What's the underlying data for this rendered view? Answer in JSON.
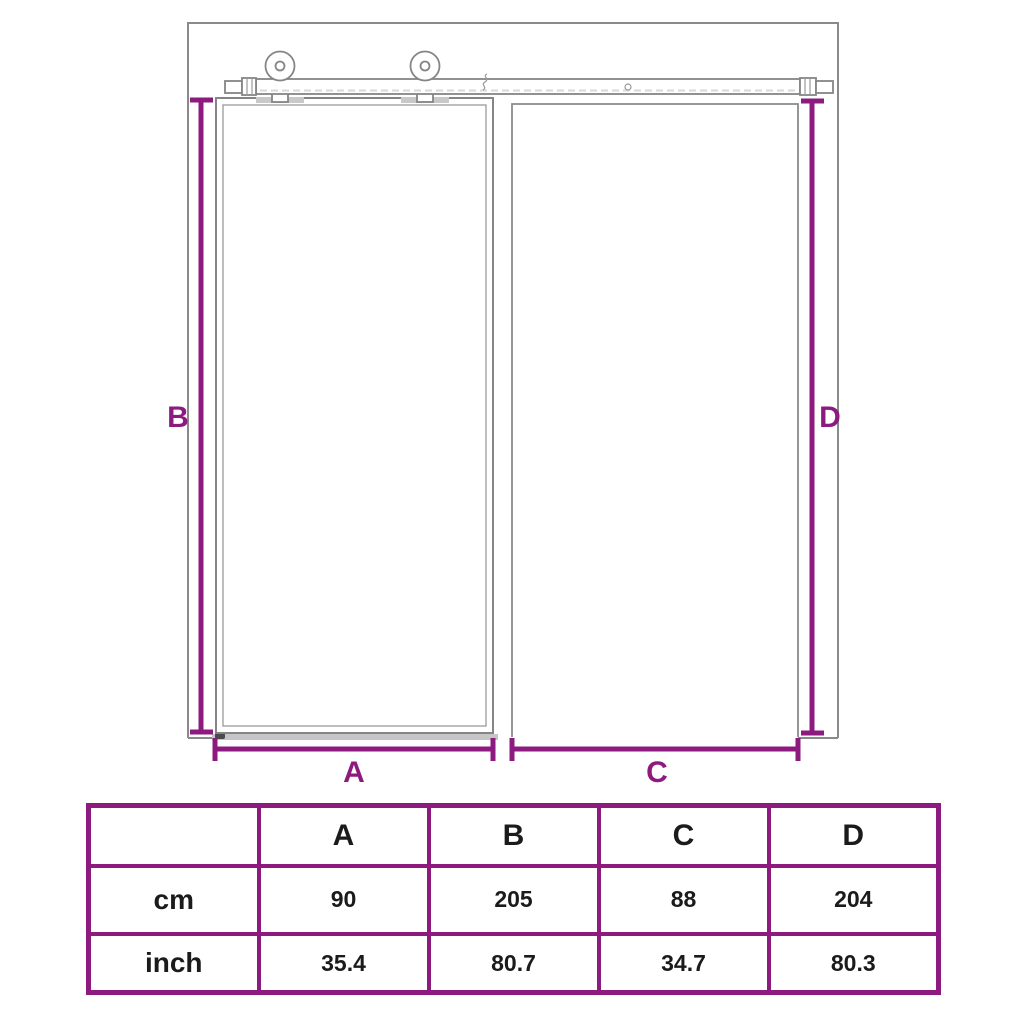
{
  "colors": {
    "accent": "#8d1b7f",
    "line": "#8a8a8a",
    "line_light": "#c6c6c6",
    "text": "#1b1b1b"
  },
  "diagram": {
    "type": "sliding-door-dimension-drawing",
    "labels": {
      "a": "A",
      "b": "B",
      "c": "C",
      "d": "D"
    }
  },
  "table": {
    "corner": "",
    "col_headers": [
      "A",
      "B",
      "C",
      "D"
    ],
    "rows": [
      {
        "label": "cm",
        "values": [
          "90",
          "205",
          "88",
          "204"
        ]
      },
      {
        "label": "inch",
        "values": [
          "35.4",
          "80.7",
          "34.7",
          "80.3"
        ]
      }
    ]
  }
}
